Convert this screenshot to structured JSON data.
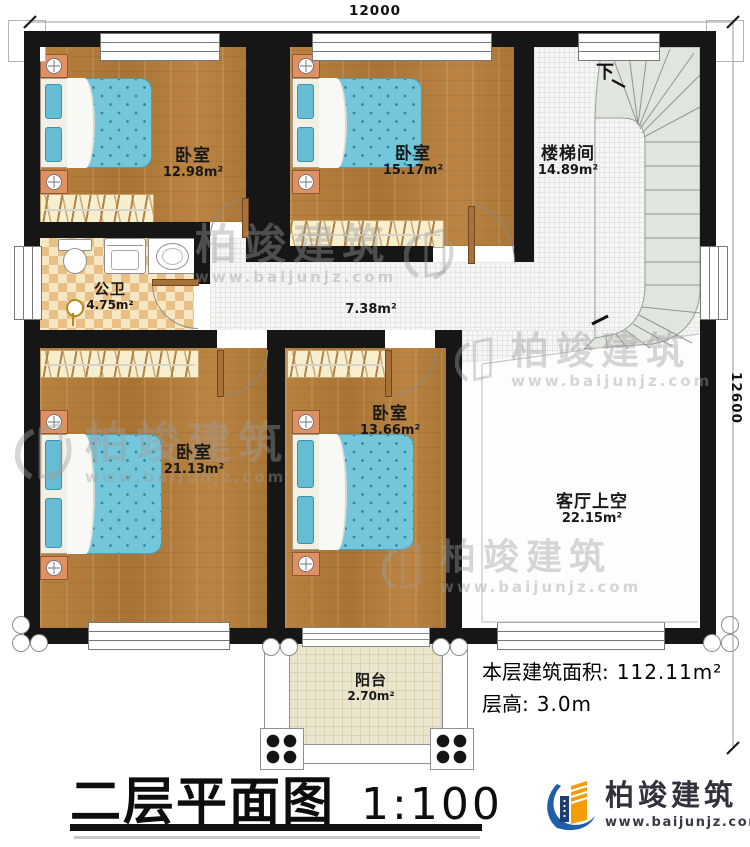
{
  "dimensions": {
    "top": "12000",
    "right": "12600"
  },
  "rooms": {
    "bedroom_tl": {
      "name": "卧室",
      "area": "12.98m²"
    },
    "bedroom_tm": {
      "name": "卧室",
      "area": "15.17m²"
    },
    "stairwell": {
      "name": "楼梯间",
      "area": "14.89m²",
      "down_label": "下"
    },
    "bathroom": {
      "name": "公卫",
      "area": "4.75m²"
    },
    "corridor": {
      "area": "7.38m²"
    },
    "bedroom_bl": {
      "name": "卧室",
      "area": "21.13m²"
    },
    "bedroom_bm": {
      "name": "卧室",
      "area": "13.66m²"
    },
    "living_void": {
      "name": "客厅上空",
      "area": "22.15m²"
    },
    "balcony": {
      "name": "阳台",
      "area": "2.70m²"
    }
  },
  "info": {
    "area_label": "本层建筑面积:",
    "area_value": "112.11m²",
    "height_label": "层高:",
    "height_value": "3.0m"
  },
  "title": {
    "text": "二层平面图",
    "scale": "1:100"
  },
  "brand": {
    "name": "柏竣建筑",
    "website": "www.baijunjz.com"
  },
  "watermark": {
    "name": "柏竣建筑",
    "website": "www.baijunjz.com"
  }
}
